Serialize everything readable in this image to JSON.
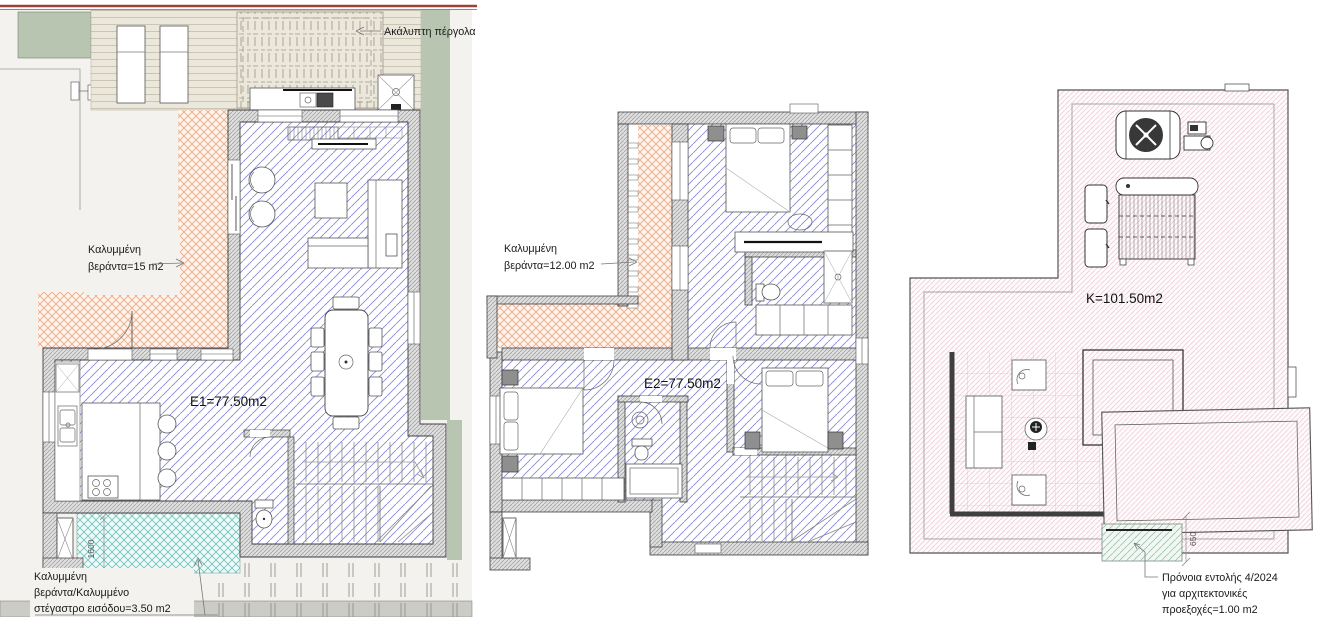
{
  "drawing": {
    "type": "architectural-floor-plans",
    "background": "#ffffff"
  },
  "colors": {
    "boundary_red": "#9c4038",
    "site_gray": "#f3f2ee",
    "green_area": "#b8c5b1",
    "deck_beige": "#ebe7db",
    "orange_veranda_hatch": "#eda583",
    "teal_porch_hatch": "#6fc3bd",
    "blue_floor_hatch": "#878bd8",
    "pink_roof_hatch": "#f0ccd7",
    "green_provision_hatch": "#9cc2af",
    "wall_gray": "#dedede",
    "road_gray": "#ccccc6"
  },
  "plans": [
    {
      "id": "ground-floor",
      "area_label": "E1=77.50m2",
      "pergola_label": "Ακάλυπτη πέργολα",
      "veranda_label_line1": "Καλυμμένη",
      "veranda_label_line2": "βεράντα=15 m2",
      "entrance_label_line1": "Καλυμμένη",
      "entrance_label_line2": "βεράντα/Καλυμμένο",
      "entrance_label_line3": "στέγαστρο εισόδου=3.50 m2",
      "porch_dim": "1600"
    },
    {
      "id": "first-floor",
      "area_label": "E2=77.50m2",
      "veranda_label_line1": "Καλυμμένη",
      "veranda_label_line2": "βεράντα=12.00 m2"
    },
    {
      "id": "roof",
      "area_label": "K=101.50m2",
      "provision_label_line1": "Πρόνοια εντολής 4/2024",
      "provision_label_line2": "για αρχιτεκτονικές",
      "provision_label_line3": "προεξοχές=1.00 m2",
      "overhang_dim": "650"
    }
  ]
}
